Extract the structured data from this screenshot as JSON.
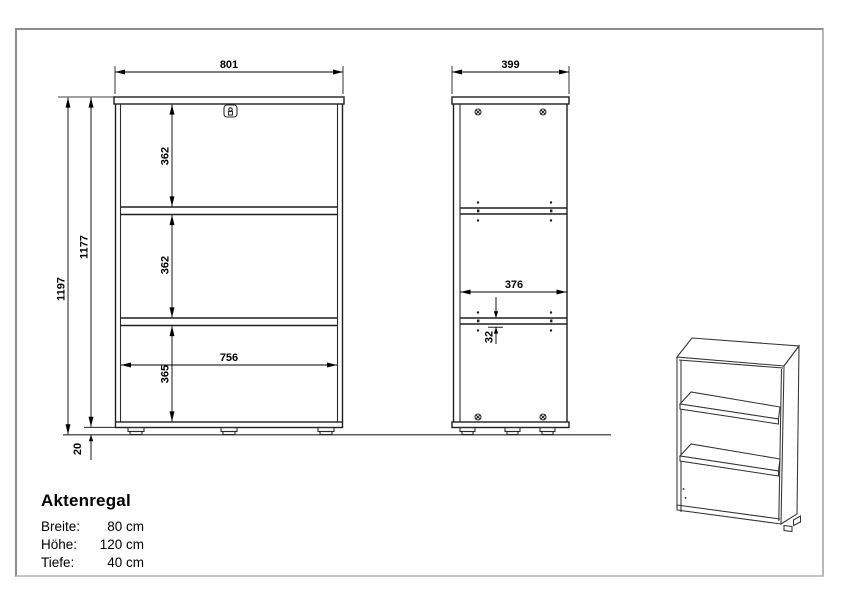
{
  "product": {
    "name": "Aktenregal",
    "specs": [
      {
        "label": "Breite:",
        "value": "80 cm"
      },
      {
        "label": "Höhe:",
        "value": "120 cm"
      },
      {
        "label": "Tiefe:",
        "value": "40 cm"
      }
    ]
  },
  "drawing": {
    "front_view": {
      "dim_width": "801",
      "dim_height_total": "1197",
      "dim_height_body": "1177",
      "dim_compartment_top": "362",
      "dim_compartment_middle": "362",
      "dim_compartment_bottom": "365",
      "dim_inner_width": "756",
      "dim_foot_height": "20"
    },
    "side_view": {
      "dim_depth": "399",
      "dim_inner_depth": "376",
      "dim_shelf_pin_offset": "32"
    }
  },
  "colors": {
    "object_line": "#1f1f1f",
    "dimension_line": "#000000",
    "page_border": "#8d8d8d"
  }
}
